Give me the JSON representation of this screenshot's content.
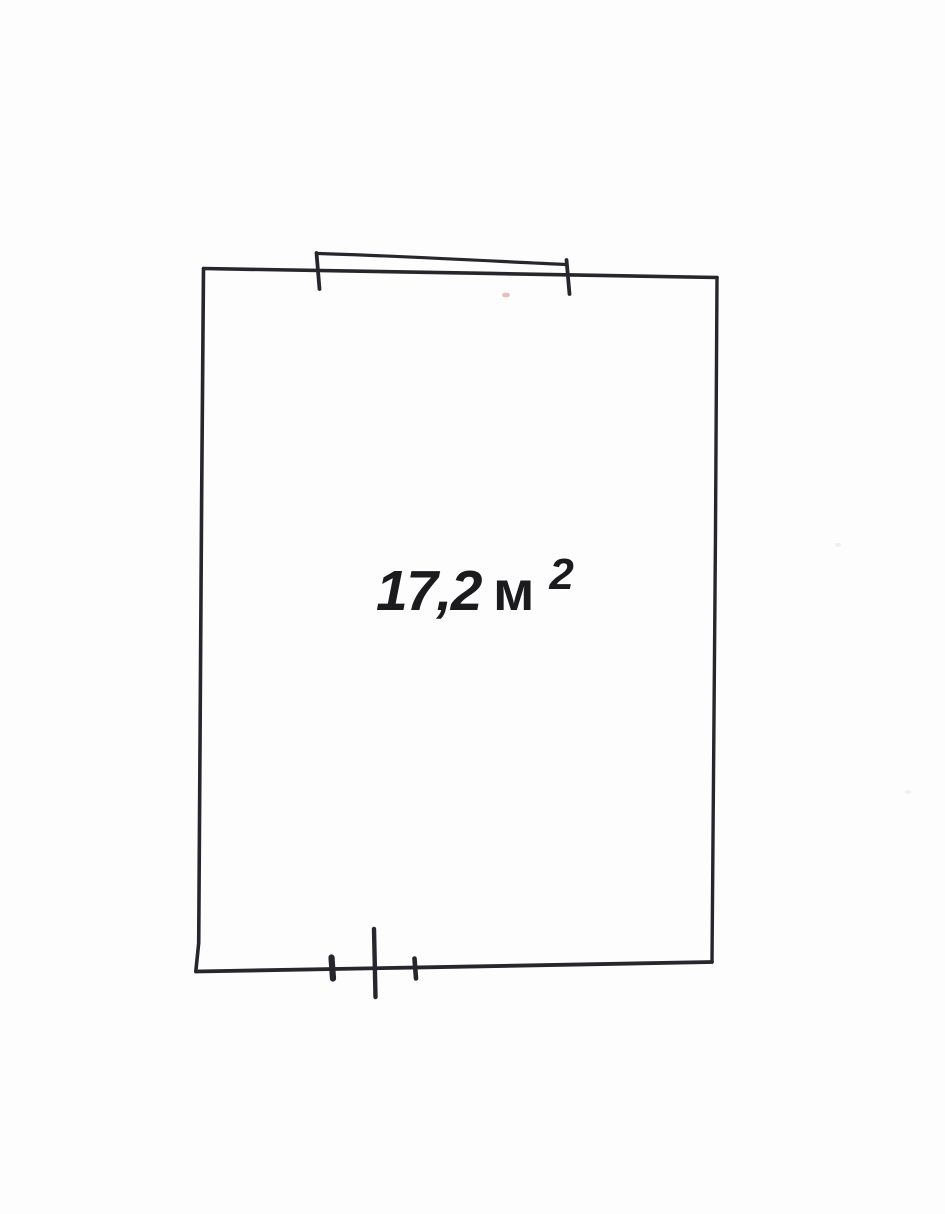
{
  "page": {
    "background_color": "#fdfdfd",
    "ink_color": "#26262c",
    "text_color": "#1b1b1e",
    "speck_color": "#e2a8a8"
  },
  "floor_plan": {
    "area_label": {
      "value": "17,2",
      "unit": "м",
      "superscript": "2",
      "full_text": "17,2 м²"
    },
    "symbols": [
      {
        "name": "window-opening",
        "wall": "top"
      },
      {
        "name": "door-opening",
        "wall": "bottom"
      }
    ]
  }
}
